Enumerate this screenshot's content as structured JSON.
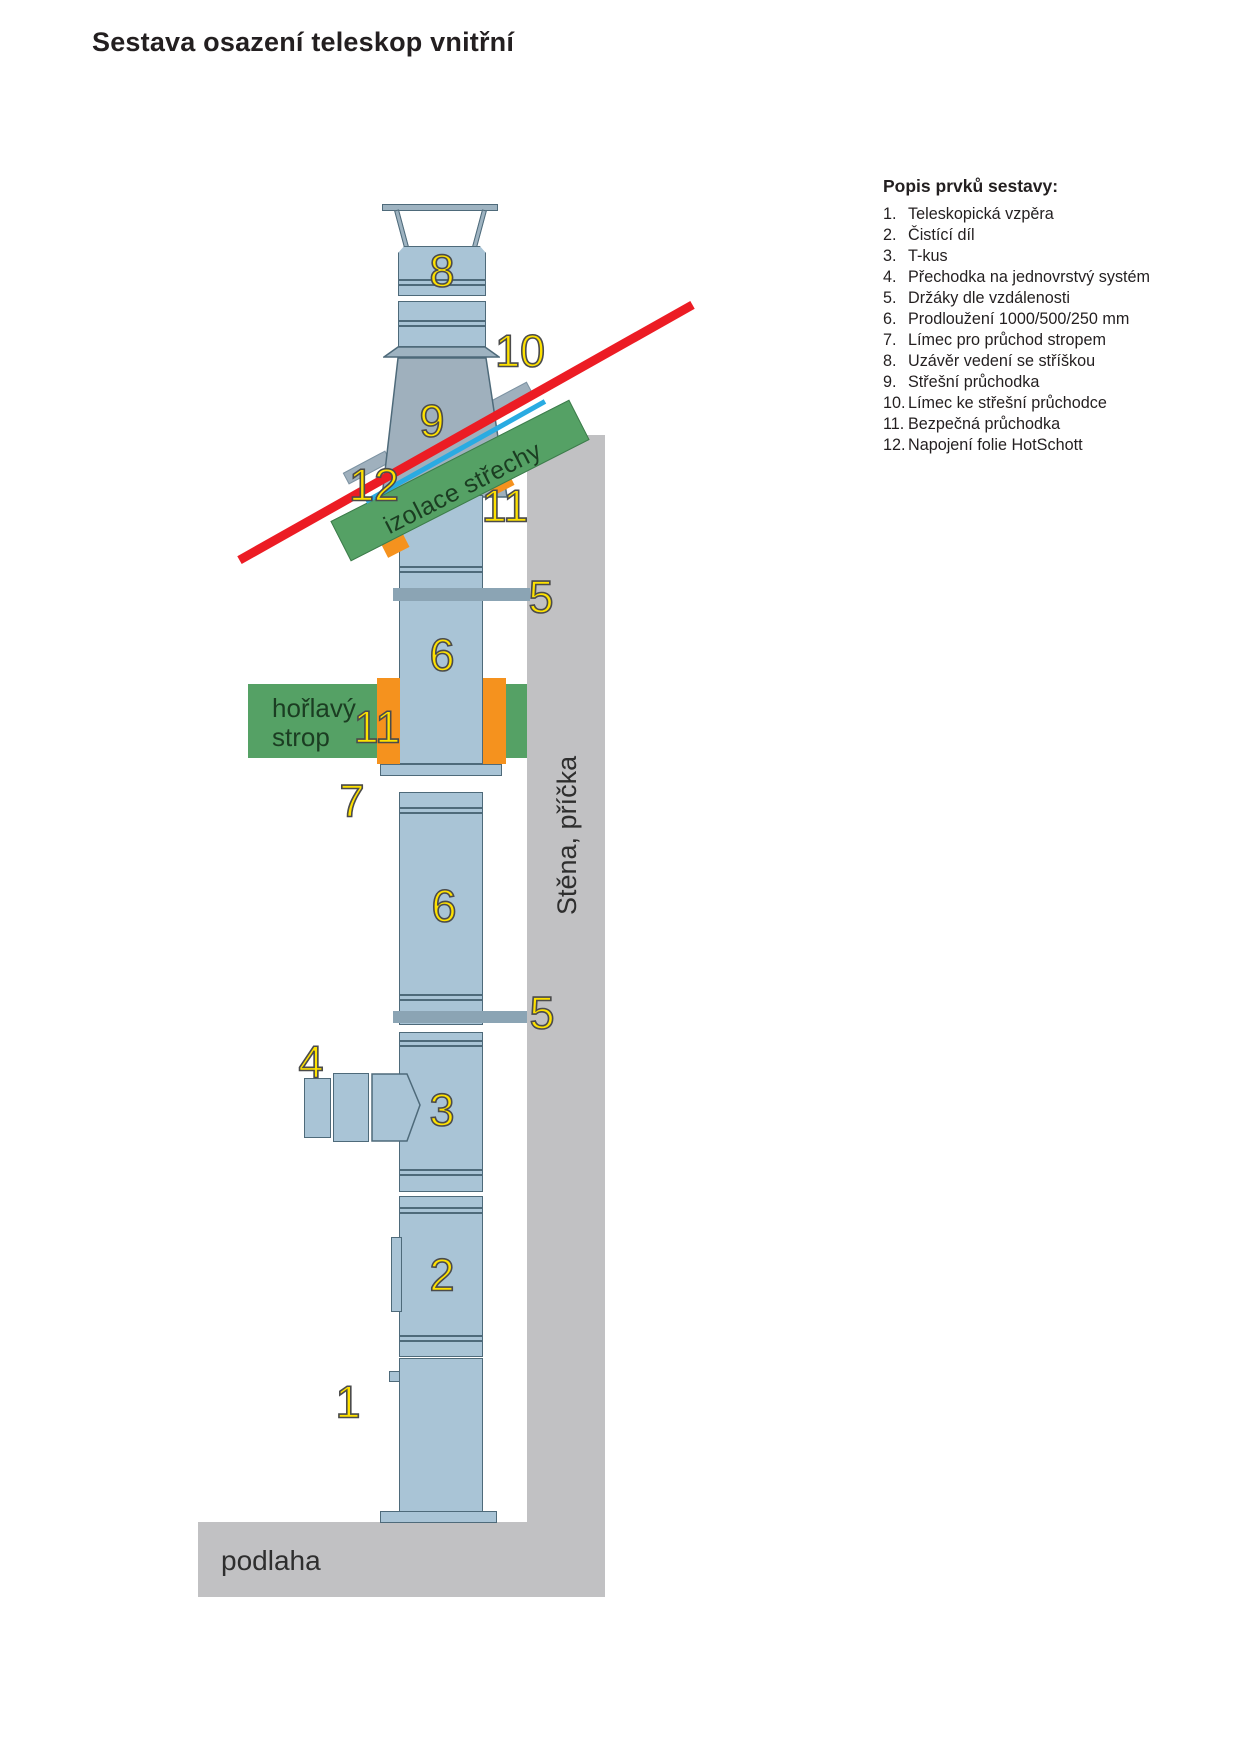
{
  "title": "Sestava osazení teleskop vnitřní",
  "legend": {
    "heading": "Popis prvků sestavy:",
    "items": [
      {
        "num": "1.",
        "text": "Teleskopická vzpěra"
      },
      {
        "num": "2.",
        "text": "Čistící díl"
      },
      {
        "num": "3.",
        "text": "T-kus"
      },
      {
        "num": "4.",
        "text": "Přechodka na jednovrstvý systém"
      },
      {
        "num": "5.",
        "text": "Držáky dle vzdálenosti"
      },
      {
        "num": "6.",
        "text": "Prodloužení 1000/500/250 mm"
      },
      {
        "num": "7.",
        "text": "Límec pro průchod stropem"
      },
      {
        "num": "8.",
        "text": "Uzávěr vedení se stříškou"
      },
      {
        "num": "9.",
        "text": "Střešní průchodka"
      },
      {
        "num": "10.",
        "text": "Límec ke střešní průchodce"
      },
      {
        "num": "11.",
        "text": "Bezpečná průchodka"
      },
      {
        "num": "12.",
        "text": "Napojení folie HotSchott"
      }
    ]
  },
  "diagram": {
    "labels": {
      "roof_insulation": "izolace střechy",
      "flammable_ceiling_line1": "hořlavý",
      "flammable_ceiling_line2": "strop",
      "wall": "Stěna, příčka",
      "floor": "podlaha"
    },
    "callouts": {
      "uzaver_8": "8",
      "limec_10": "10",
      "pruchodka_9": "9",
      "folie_12": "12",
      "bezpecna_11_roof": "11",
      "drzak_5_upper": "5",
      "prodlouzeni_6_upper": "6",
      "bezpecna_11_ceiling": "11",
      "limec_7": "7",
      "prodlouzeni_6_lower": "6",
      "drzak_5_lower": "5",
      "prechodka_4": "4",
      "tkus_3": "3",
      "cistici_2": "2",
      "vzpera_1": "1"
    }
  },
  "colors": {
    "pipe": "#a9c4d6",
    "pipe_outline": "#4e6a7a",
    "metal_gray": "#9fb0bd",
    "bracket": "#8ba4b4",
    "wall_floor": "#c1c1c3",
    "roof_line_red": "#ec1c24",
    "foil_line_cyan": "#2aabe2",
    "insulation_green": "#55a165",
    "penetration_orange": "#f5921e",
    "callout_yellow": "#ffe200"
  }
}
